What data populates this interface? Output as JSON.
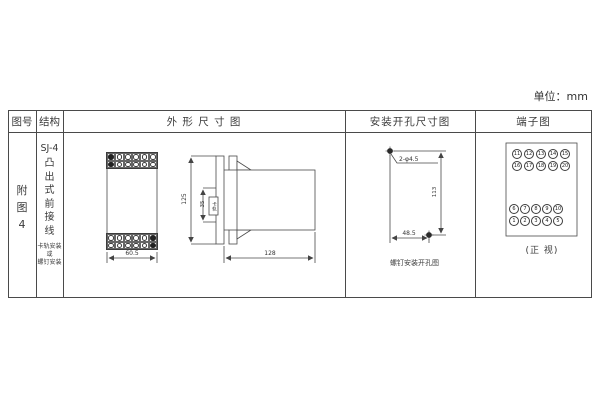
{
  "unit": "单位：mm",
  "headers": {
    "figure_no": "图号",
    "structure": "结构",
    "outline": "外 形 尺 寸 图",
    "mounting": "安装开孔尺寸图",
    "terminal": "端子图"
  },
  "figure": {
    "chars": [
      "附",
      "图",
      "4"
    ]
  },
  "structure": {
    "model": "SJ-4",
    "type_chars": [
      "凸",
      "出",
      "式",
      "前",
      "接",
      "线"
    ],
    "mount_lines": [
      "卡轨安装",
      "或",
      "螺钉安装"
    ]
  },
  "outline_dims": {
    "front_width": "60.5",
    "height": "125",
    "rail": "35",
    "rail_label": "卡轨",
    "depth": "128"
  },
  "mounting_view": {
    "hole_label": "2-φ4.5",
    "vertical": "113",
    "horizontal": "48.5",
    "caption": "螺钉安装开孔图"
  },
  "terminal_view": {
    "caption": "(正 视)",
    "top": [
      [
        "11",
        "12",
        "13",
        "14",
        "15"
      ],
      [
        "16",
        "17",
        "18",
        "19",
        "20"
      ]
    ],
    "bottom": [
      [
        "6",
        "7",
        "8",
        "9",
        "10"
      ],
      [
        "1",
        "2",
        "3",
        "4",
        "5"
      ]
    ]
  }
}
